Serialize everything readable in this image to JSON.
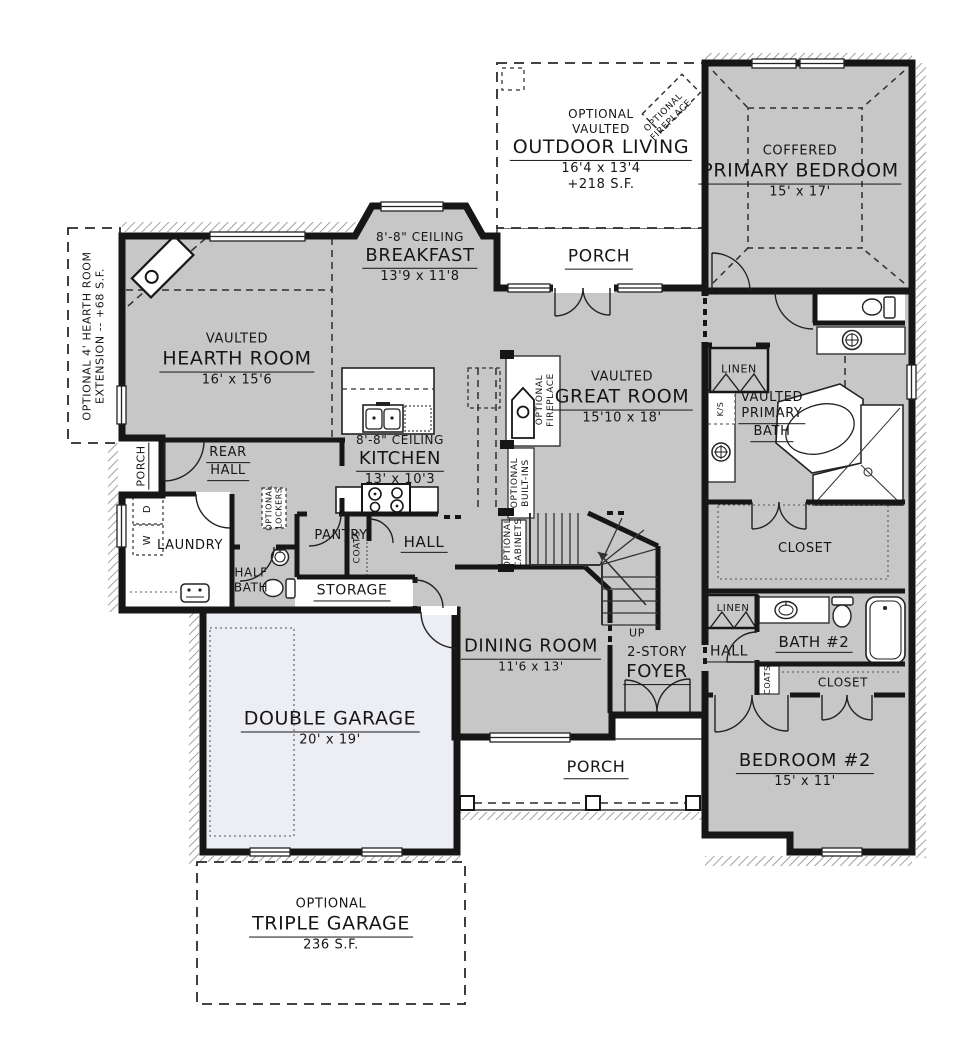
{
  "colors": {
    "room_fill": "#c7c7c7",
    "garage_fill": "#edeef4",
    "wall": "#161616",
    "line": "#3a3a3a"
  },
  "rooms": {
    "outdoor_living": {
      "opt": "OPTIONAL",
      "ceil": "VAULTED",
      "name": "OUTDOOR LIVING",
      "dims": "16'4 x 13'4",
      "area": "+218 S.F."
    },
    "outdoor_fireplace": {
      "line1": "OPTIONAL",
      "line2": "FIREPLACE"
    },
    "rear_porch": {
      "name": "PORCH"
    },
    "primary_bedroom": {
      "ceil": "COFFERED",
      "name": "PRIMARY BEDROOM",
      "dims": "15' x 17'"
    },
    "breakfast": {
      "ceil": "8'-8\" CEILING",
      "name": "BREAKFAST",
      "dims": "13'9 x 11'8"
    },
    "hearth_room": {
      "ceil": "VAULTED",
      "name": "HEARTH ROOM",
      "dims": "16' x 15'6"
    },
    "great_room": {
      "ceil": "VAULTED",
      "name": "GREAT ROOM",
      "dims": "15'10 x 18'"
    },
    "kitchen": {
      "ceil": "8'-8\" CEILING",
      "name": "KITCHEN",
      "dims": "13' x 10'3"
    },
    "hearth_extension": {
      "line1": "OPTIONAL 4' HEARTH ROOM",
      "line2": "EXTENSION -- +68 S.F."
    },
    "side_porch": {
      "name": "PORCH"
    },
    "rear_hall": {
      "line1": "REAR",
      "line2": "HALL"
    },
    "laundry": {
      "name": "LAUNDRY",
      "washer": "W",
      "dryer": "D"
    },
    "optional_lockers": {
      "line1": "OPTIONAL",
      "line2": "LOCKERS"
    },
    "half_bath": {
      "line1": "HALF",
      "line2": "BATH"
    },
    "pantry": {
      "name": "PANTRY"
    },
    "coats_main": {
      "name": "COATS"
    },
    "hall_main": {
      "name": "HALL"
    },
    "storage": {
      "name": "STORAGE"
    },
    "optional_fireplace": {
      "line1": "OPTIONAL",
      "line2": "FIREPLACE"
    },
    "optional_builtins": {
      "line1": "OPTIONAL",
      "line2": "BUILT-INS"
    },
    "optional_cabinets": {
      "line1": "OPTIONAL",
      "line2": "CABINETS"
    },
    "dining_room": {
      "name": "DINING ROOM",
      "dims": "11'6 x 13'"
    },
    "stairs": {
      "up": "UP"
    },
    "foyer": {
      "line1": "2-STORY",
      "name": "FOYER"
    },
    "linen_primary": {
      "name": "LINEN"
    },
    "knee_space": {
      "name": "K/S"
    },
    "primary_bath": {
      "ceil": "VAULTED",
      "line1": "PRIMARY",
      "line2": "BATH"
    },
    "primary_closet": {
      "name": "CLOSET"
    },
    "linen_hall": {
      "name": "LINEN"
    },
    "hall_bedroom": {
      "name": "HALL"
    },
    "bath_2": {
      "name": "BATH #2"
    },
    "coats_bedroom": {
      "name": "COATS"
    },
    "closet_2": {
      "name": "CLOSET"
    },
    "bedroom_2": {
      "name": "BEDROOM #2",
      "dims": "15' x 11'"
    },
    "double_garage": {
      "name": "DOUBLE GARAGE",
      "dims": "20' x 19'"
    },
    "front_porch": {
      "name": "PORCH"
    },
    "triple_garage": {
      "opt": "OPTIONAL",
      "name": "TRIPLE GARAGE",
      "area": "236 S.F."
    }
  }
}
